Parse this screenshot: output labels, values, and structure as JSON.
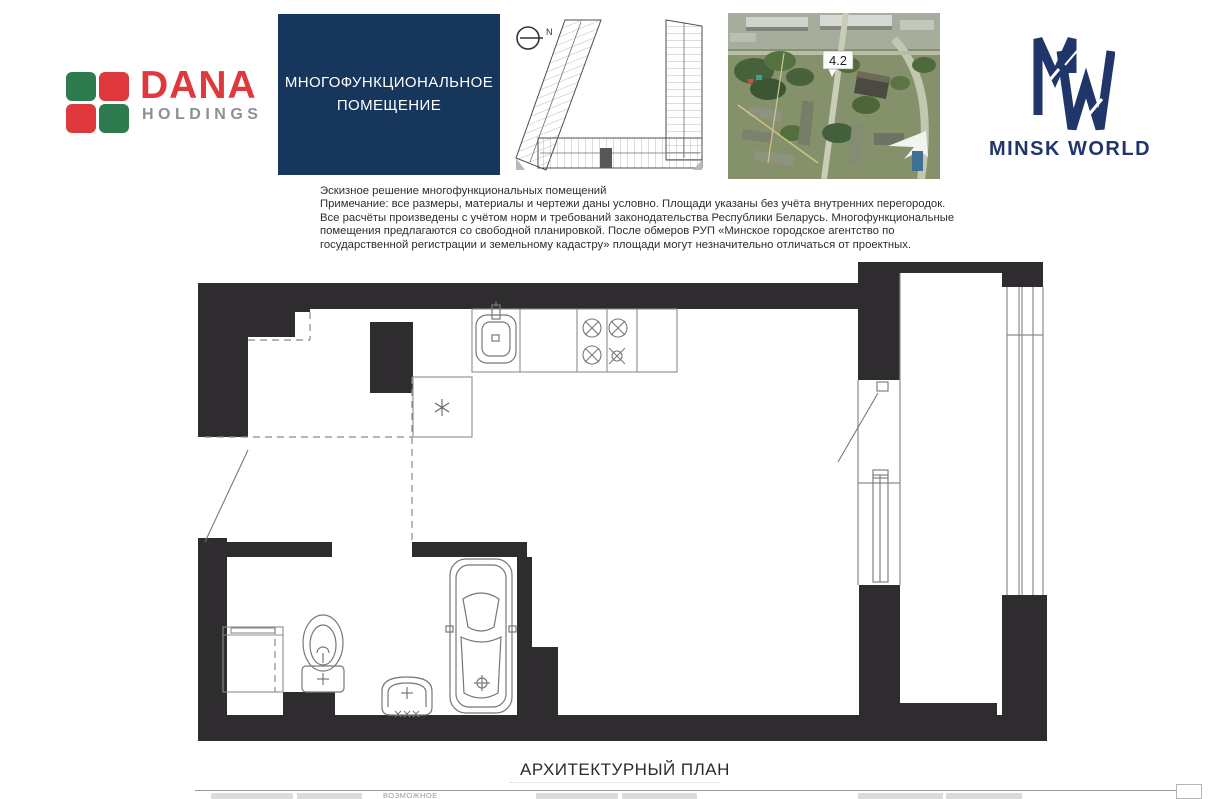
{
  "header": {
    "dana_logo": {
      "name": "DANA",
      "subtitle": "HOLDINGS",
      "red": "#e0393d",
      "green": "#2e7b50",
      "gray": "#8a9095"
    },
    "unit_banner": {
      "line1": "МНОГОФУНКЦИОНАЛЬНОЕ",
      "line2": "ПОМЕЩЕНИЕ",
      "bg": "#16365c"
    },
    "floor_key_plan": {
      "north_label": "N"
    },
    "aerial_view": {
      "building_label": "4.2"
    },
    "minsk_world_logo": {
      "brand": "MINSK WORLD",
      "navy": "#20366b"
    }
  },
  "disclaimer": {
    "lines": [
      "Эскизное решение многофункциональных помещений",
      "Примечание: все размеры, материалы и чертежи даны условно. Площади указаны без учёта внутренних перегородок.",
      "Все расчёты произведены с учётом норм и требований законодательства Республики Беларусь. Многофункциональные",
      "помещения предлагаются со свободной планировкой. После обмеров РУП «Минское городское агентство по",
      "государственной регистрации и земельному кадастру» площади могут незначительно отличаться от проектных."
    ]
  },
  "plan": {
    "title": "АРХИТЕКТУРНЫЙ ПЛАН",
    "wall_color": "#2e2c2e"
  },
  "footer": {
    "legend_label": "ВОЗМОЖНОЕ"
  }
}
